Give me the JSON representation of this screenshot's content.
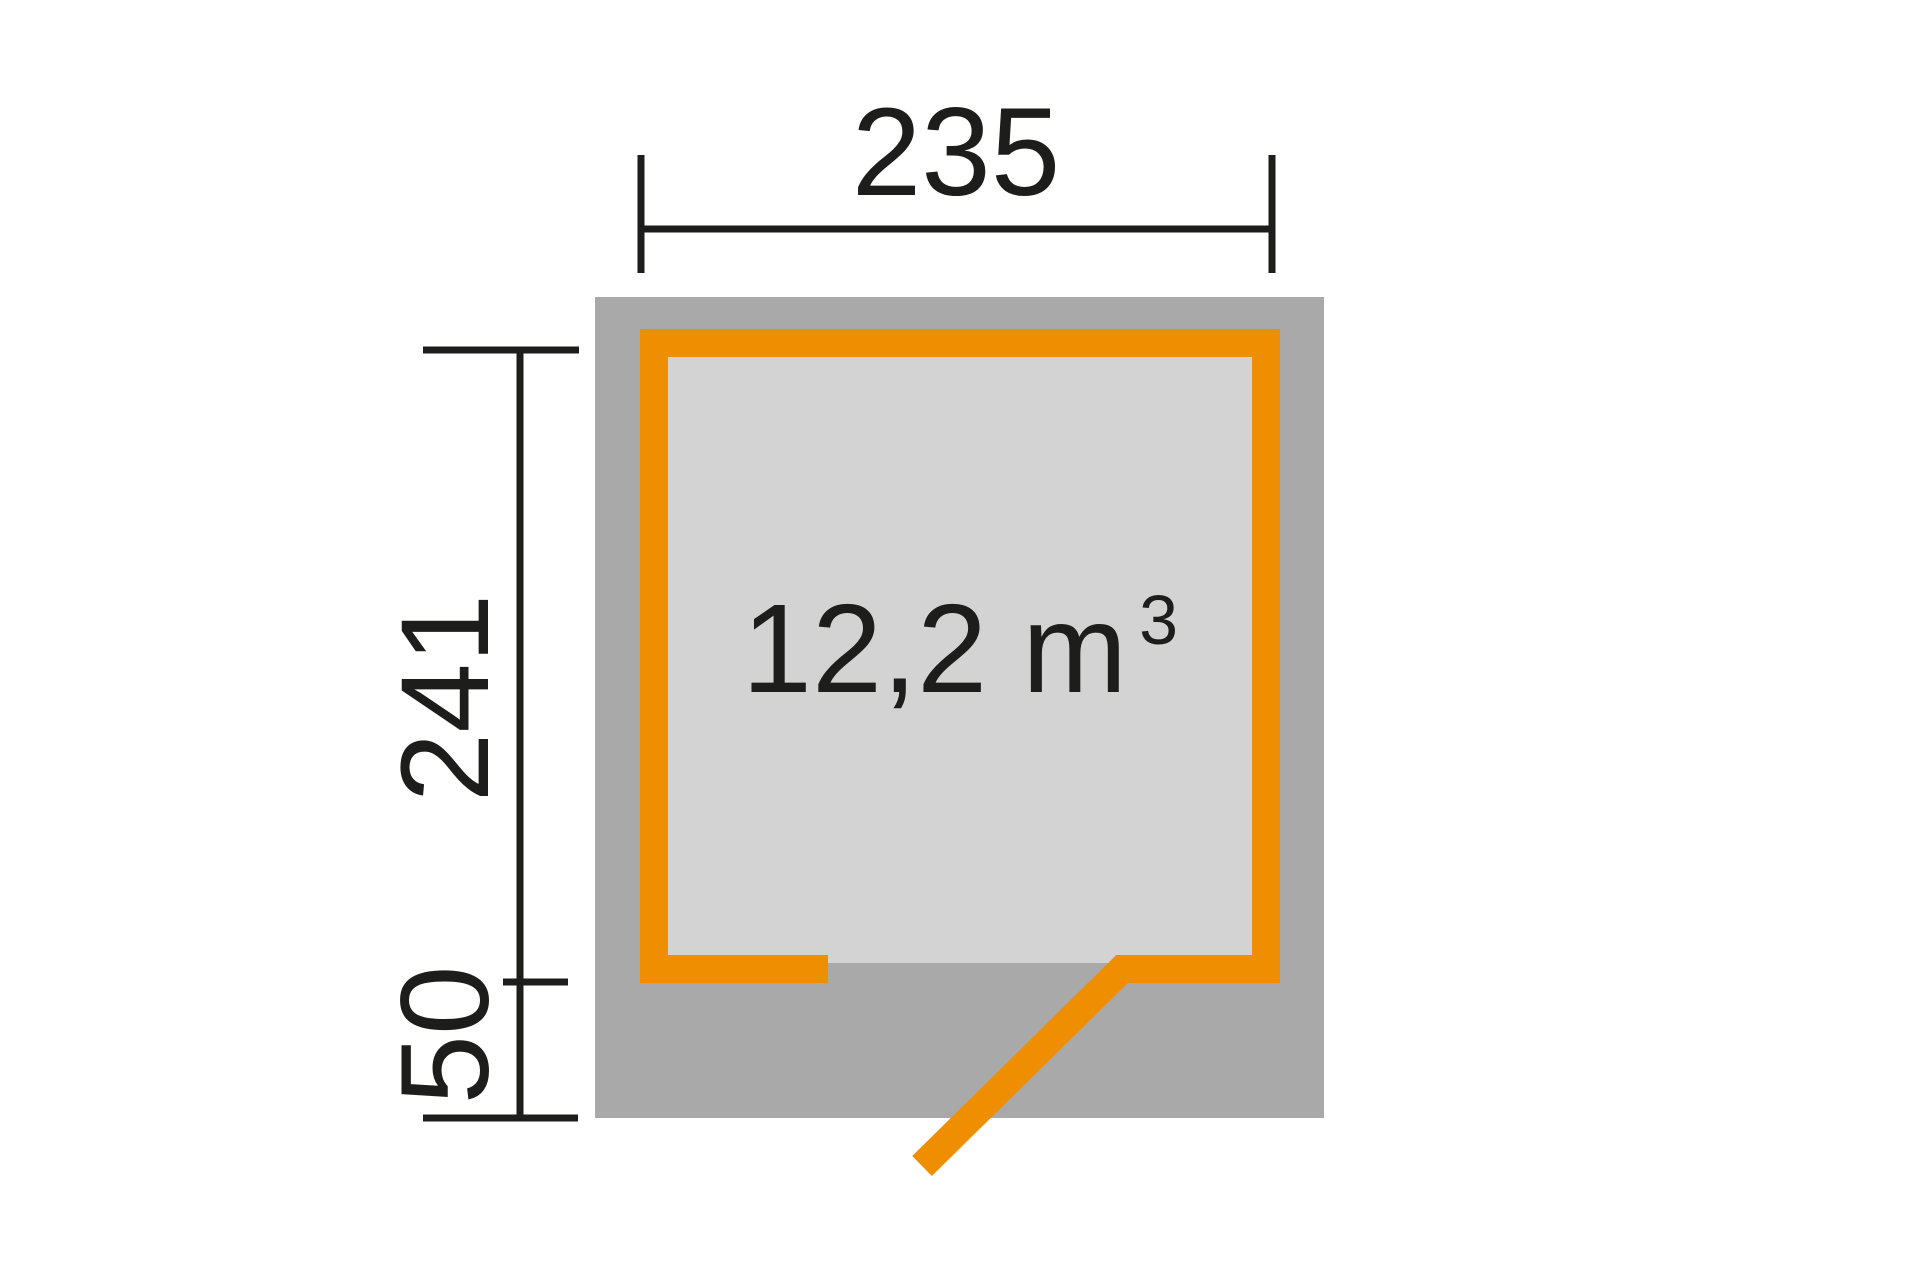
{
  "diagram": {
    "type": "shed-floor-plan",
    "volume": {
      "value": "12,2 m",
      "superscript": "3"
    },
    "dimensions": {
      "width_label": "235",
      "depth_label": "241",
      "door_offset_label": "50"
    },
    "colors": {
      "orange": "#EF8E00",
      "footprint_gray": "#A9A9A9",
      "interior_gray": "#D3D3D3",
      "line_black": "#1D1D1B",
      "background": "#FFFFFF"
    }
  }
}
